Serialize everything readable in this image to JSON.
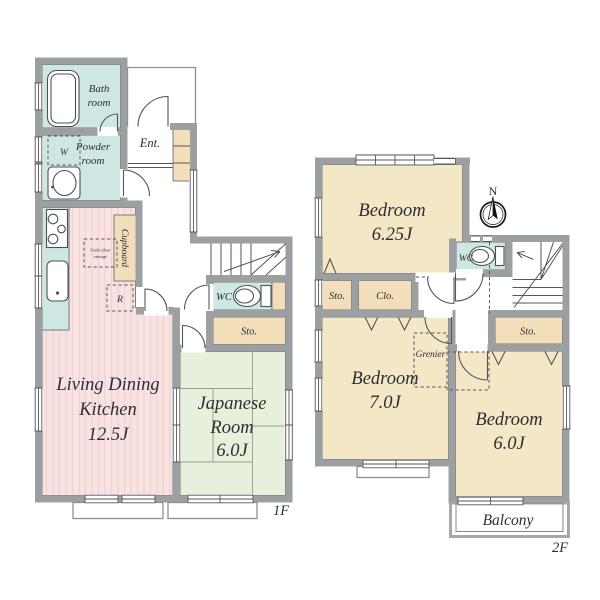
{
  "floor1": {
    "tag": "1F",
    "bath": [
      "Bath",
      "room"
    ],
    "powder": [
      "Powder",
      "room"
    ],
    "entrance": "Ent.",
    "cupboard": "Cupboard",
    "washer": "W",
    "fridge": "R",
    "under_floor": [
      "Under floor",
      "storage"
    ],
    "wc": "WC",
    "storage": "Sto.",
    "ldk": [
      "Living Dining",
      "Kitchen",
      "12.5J"
    ],
    "japanese_room": [
      "Japanese",
      "Room",
      "6.0J"
    ]
  },
  "floor2": {
    "tag": "2F",
    "bedroom_625": [
      "Bedroom",
      "6.25J"
    ],
    "bedroom_70": [
      "Bedroom",
      "7.0J"
    ],
    "bedroom_60": [
      "Bedroom",
      "6.0J"
    ],
    "wc": "WC",
    "storage_left": "Sto.",
    "closet": "Clo.",
    "storage_right": "Sto.",
    "grenier": "Grenier",
    "balcony": "Balcony",
    "compass_north": "N"
  },
  "colors": {
    "wall": "#9da0a3",
    "wet_area": "#cfe7e2",
    "flooring": "#f9e2e1",
    "flooring_stripe": "#eed0cf",
    "tatami": "#e6f0da",
    "bedroom": "#f3e7c5",
    "cabinet": "#f2dfba",
    "under_floor_box": "#f5e8d5",
    "text": "#2d2d36"
  }
}
